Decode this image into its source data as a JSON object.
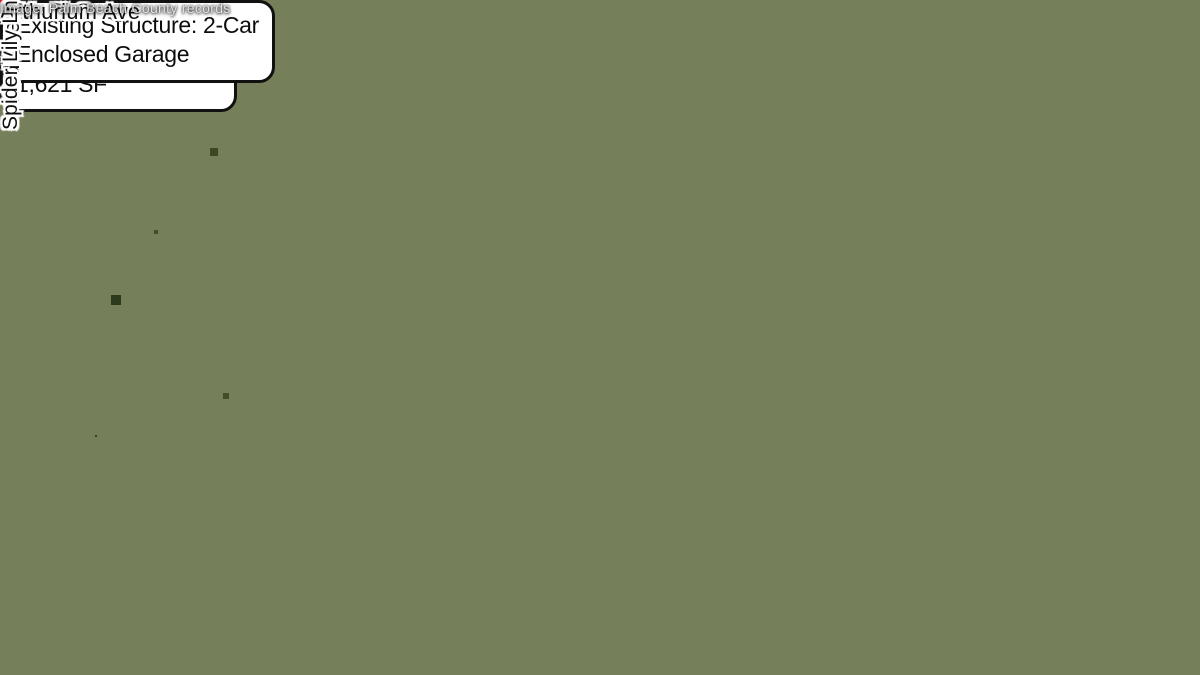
{
  "window": {
    "width": 1200,
    "height": 675
  },
  "map": {
    "type": "aerial-photo-annotation",
    "street_labels": [
      {
        "id": "43rd-ave-s",
        "text": "43rd Ave S",
        "orientation": "vertical"
      },
      {
        "id": "67th-pl-s",
        "text": "67th Pl S",
        "orientation": "horizontal"
      },
      {
        "id": "arthurium-ave",
        "text": "Arthurium Ave",
        "orientation": "horizontal"
      },
      {
        "id": "spider-lily-ln",
        "text": "Spider Lily Ln",
        "orientation": "vertical"
      }
    ],
    "callouts": [
      {
        "id": "house",
        "lines": [
          "Existing Structure:",
          "Single Family House",
          "1,621 SF"
        ]
      },
      {
        "id": "garage",
        "lines": [
          "Existing Structure: 2-Car",
          "Enclosed Garage"
        ]
      }
    ],
    "credit": "Image: Palm Beach County records",
    "colors": {
      "parcel_outline": "#dc1010",
      "callout_border": "#111111",
      "callout_bg": "#ffffff",
      "label_text": "#101010",
      "label_halo": "#ffffff",
      "credit_text": "#e3e3e3"
    }
  }
}
